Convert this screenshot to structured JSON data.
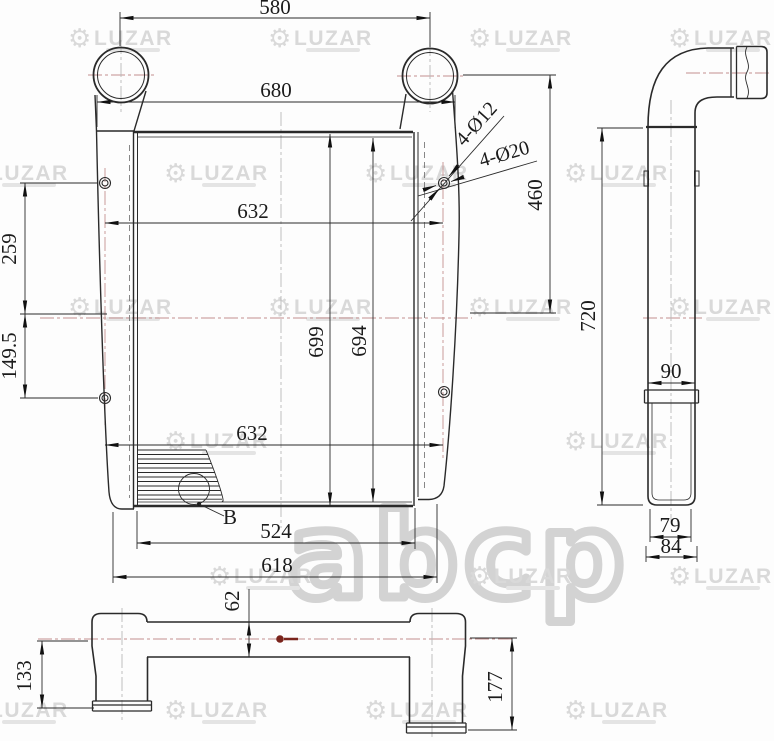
{
  "drawing": {
    "brand_watermark": "LUZAR",
    "center_watermark": "abcp",
    "front_view": {
      "dim_pipe_spacing": "580",
      "dim_overall_width": "680",
      "dim_core_width_upper": "632",
      "dim_core_width_lower": "632",
      "dim_core_height_outer": "699",
      "dim_core_height_inner": "694",
      "dim_mount_upper_offset": "259",
      "dim_mount_lower_offset": "149.5",
      "dim_port_to_mount_drop": "460",
      "dim_bottom_inner_width": "524",
      "dim_bottom_overall_width": "618",
      "callout_holes_small": "4-Ø12",
      "callout_holes_large": "4-Ø20",
      "detail_label": "B"
    },
    "side_view": {
      "dim_height": "720",
      "dim_duct_width": "90",
      "dim_outlet_inner_width": "79",
      "dim_outlet_outer_width": "84"
    },
    "bottom_view": {
      "dim_left_pipe_drop": "133",
      "dim_body_depth": "62",
      "dim_right_pipe_drop": "177"
    }
  }
}
